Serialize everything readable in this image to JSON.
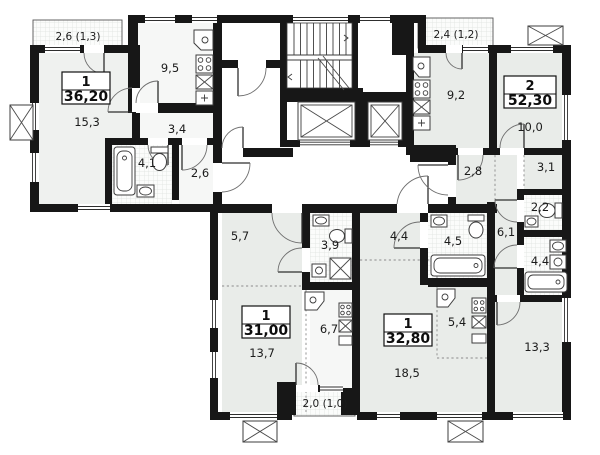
{
  "plan": {
    "type": "residential-floor-plan",
    "colors": {
      "wall": "#171717",
      "room_tint": "#e9ece9",
      "paper": "#ffffff"
    }
  },
  "apartments": [
    {
      "type": "1",
      "total_area": "36,20",
      "balcony_area": "2,6 (1,3)",
      "rooms": [
        {
          "name": "living-room",
          "area": "15,3"
        },
        {
          "name": "kitchen",
          "area": "9,5"
        },
        {
          "name": "hallway",
          "area": "3,4"
        },
        {
          "name": "bathroom",
          "area": "4,1"
        },
        {
          "name": "entry-hall",
          "area": "2,6"
        }
      ]
    },
    {
      "type": "2",
      "total_area": "52,30",
      "balcony_area": "2,4 (1,2)",
      "rooms": [
        {
          "name": "kitchen",
          "area": "9,2"
        },
        {
          "name": "living-room",
          "area": "10,0"
        },
        {
          "name": "entry-hall",
          "area": "2,8"
        },
        {
          "name": "wardrobe",
          "area": "3,1"
        },
        {
          "name": "wc",
          "area": "2,2"
        },
        {
          "name": "hallway",
          "area": "6,1"
        },
        {
          "name": "bathroom",
          "area": "4,4"
        },
        {
          "name": "bedroom",
          "area": "13,3"
        }
      ]
    },
    {
      "type": "1",
      "total_area": "31,00",
      "balcony_area": "2,0 (1,0)",
      "rooms": [
        {
          "name": "entry-hall",
          "area": "5,7"
        },
        {
          "name": "bathroom",
          "area": "3,9"
        },
        {
          "name": "living-room",
          "area": "13,7"
        },
        {
          "name": "kitchen",
          "area": "6,7"
        }
      ]
    },
    {
      "type": "1",
      "total_area": "32,80",
      "rooms": [
        {
          "name": "entry-hall",
          "area": "4,4"
        },
        {
          "name": "bathroom",
          "area": "4,5"
        },
        {
          "name": "kitchen",
          "area": "5,4"
        },
        {
          "name": "living-room",
          "area": "18,5"
        }
      ]
    }
  ]
}
